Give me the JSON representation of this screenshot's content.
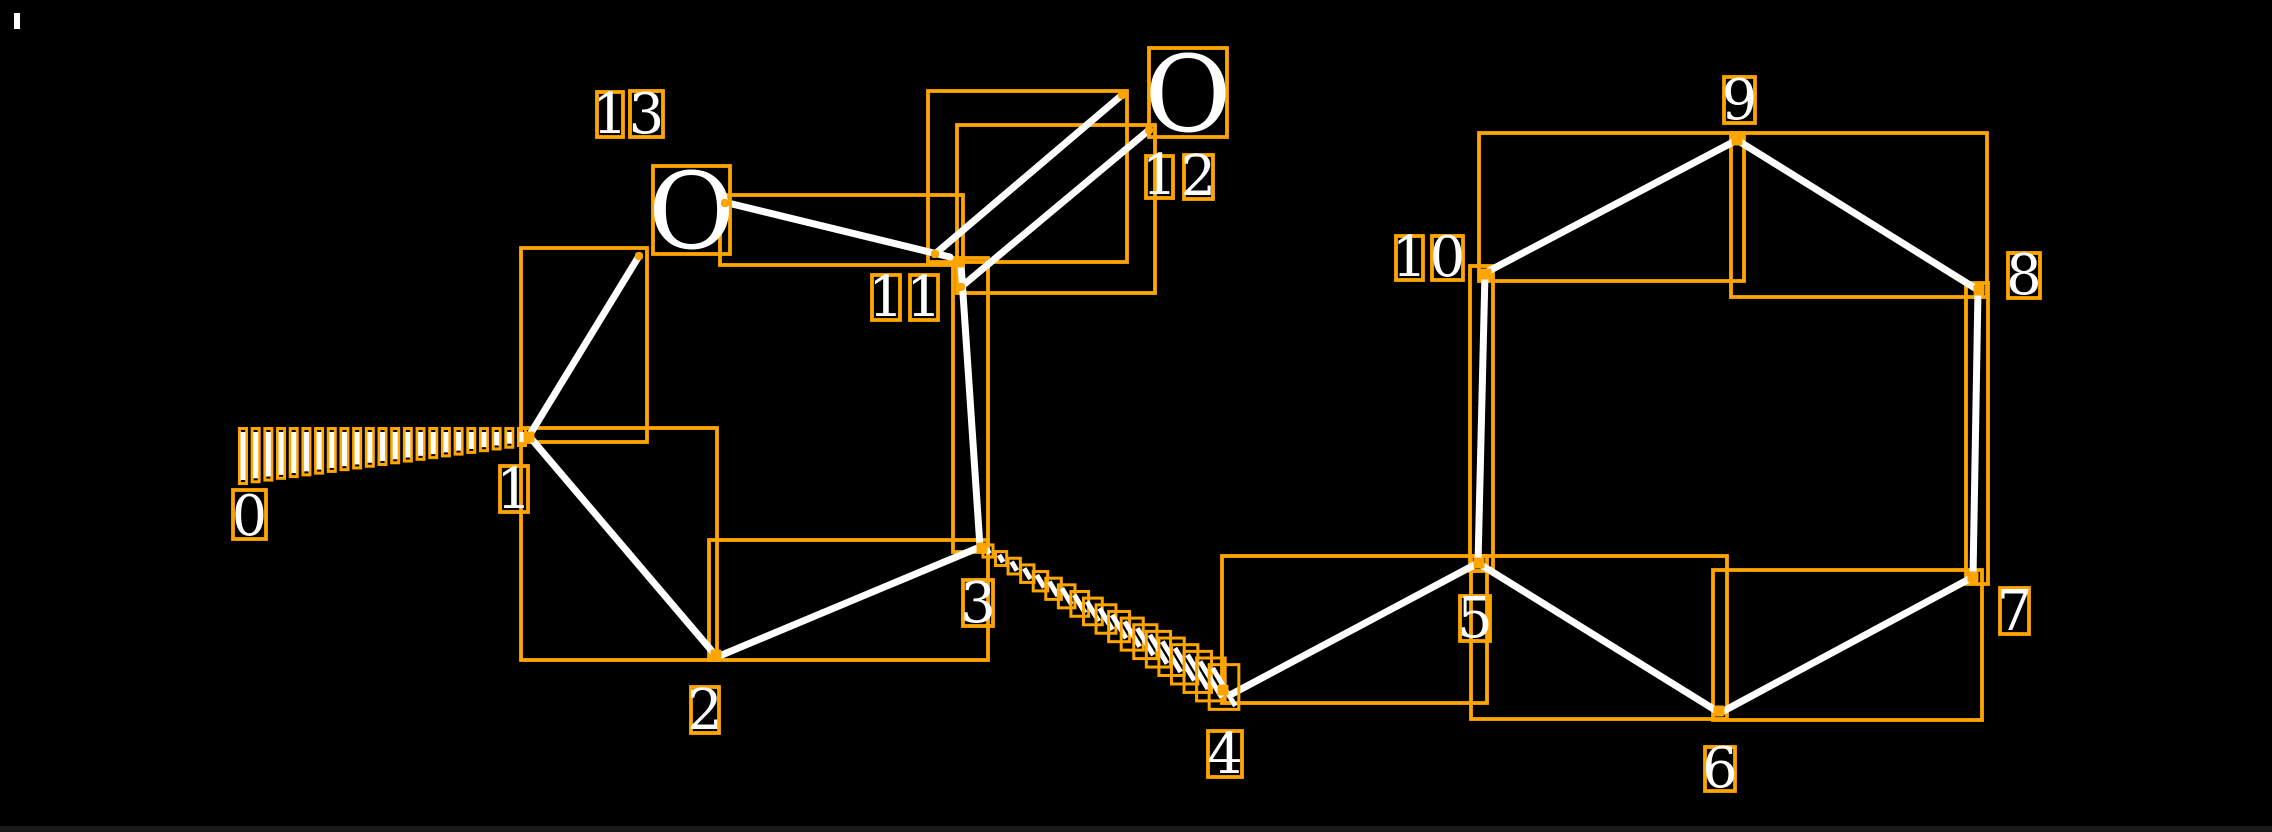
{
  "canvas": {
    "width": 2272,
    "height": 832,
    "background": "#000000",
    "footer_bar": {
      "y": 826,
      "height": 6,
      "color": "#1a1a1a"
    },
    "artifact_speck": {
      "x": 14,
      "y": 13,
      "w": 6,
      "h": 16
    }
  },
  "colors": {
    "box": "#FFA500",
    "bond": "#FFFFFF",
    "label": "#FFFFFF"
  },
  "style": {
    "bond_width": 7,
    "box_stroke": 3.8,
    "dash_width": 5,
    "dash_box_pad": 3.5,
    "digit_font": 56,
    "oxygen_font": 106,
    "marker_size": 11,
    "dot_size": 8
  },
  "molecule": {
    "oxygen_atoms": [
      {
        "name": "oxygen-13",
        "label": "O",
        "box": [
          653,
          166,
          77,
          88
        ]
      },
      {
        "name": "oxygen-12",
        "label": "O",
        "box": [
          1149,
          48,
          78,
          89
        ]
      }
    ],
    "bonds": [
      {
        "name": "bond-1-2",
        "p": [
          529,
          436,
          717,
          657
        ]
      },
      {
        "name": "bond-2-3",
        "p": [
          717,
          657,
          980,
          547
        ]
      },
      {
        "name": "bond-11-3",
        "p": [
          961,
          264,
          980,
          547
        ]
      },
      {
        "name": "bond-1-o13",
        "p": [
          529,
          436,
          639,
          256
        ]
      },
      {
        "name": "bond-o13-11",
        "p": [
          728,
          203,
          950,
          257
        ]
      },
      {
        "name": "bond-11-o12-main",
        "p": [
          935,
          254,
          1122,
          95
        ]
      },
      {
        "name": "bond-11-o12-second",
        "p": [
          961,
          287,
          1149,
          130
        ]
      },
      {
        "name": "bond-4-5",
        "p": [
          1230,
          695,
          1478,
          563
        ]
      },
      {
        "name": "bond-5-6",
        "p": [
          1478,
          563,
          1720,
          713
        ]
      },
      {
        "name": "bond-6-7",
        "p": [
          1720,
          713,
          1973,
          577
        ]
      },
      {
        "name": "bond-7-8",
        "p": [
          1973,
          577,
          1978,
          290
        ]
      },
      {
        "name": "bond-8-9",
        "p": [
          1978,
          290,
          1737,
          140
        ]
      },
      {
        "name": "bond-9-10",
        "p": [
          1737,
          140,
          1485,
          273
        ]
      },
      {
        "name": "bond-10-5",
        "p": [
          1485,
          273,
          1478,
          563
        ]
      }
    ],
    "hash_wedges": [
      {
        "name": "hash-wedge-1-0",
        "x1": 522,
        "y1": 437,
        "x2": 243,
        "y2": 456,
        "count": 23,
        "len1": 10,
        "len2": 48,
        "angle_deg": 90
      },
      {
        "name": "hash-wedge-3-4",
        "x1": 988,
        "y1": 551,
        "x2": 1224,
        "y2": 687,
        "count": 19,
        "len1": 6,
        "len2": 44,
        "angle_deg": 121
      }
    ],
    "bond_boxes": [
      {
        "name": "bbox-bond-1-2",
        "r": [
          521,
          428,
          196,
          232
        ]
      },
      {
        "name": "bbox-bond-2-3",
        "r": [
          709,
          540,
          279,
          120
        ]
      },
      {
        "name": "bbox-bond-11-3",
        "r": [
          953,
          258,
          35,
          294
        ]
      },
      {
        "name": "bbox-bond-1-o13",
        "r": [
          521,
          248,
          126,
          194
        ]
      },
      {
        "name": "bbox-bond-o13-11",
        "r": [
          720,
          195,
          243,
          70
        ]
      },
      {
        "name": "bbox-bond-11-o12-main",
        "r": [
          928,
          91,
          199,
          171
        ]
      },
      {
        "name": "bbox-bond-11-o12-second",
        "r": [
          957,
          125,
          198,
          168
        ]
      },
      {
        "name": "bbox-bond-4-5",
        "r": [
          1222,
          556,
          265,
          147
        ]
      },
      {
        "name": "bbox-bond-5-6",
        "r": [
          1471,
          556,
          256,
          163
        ]
      },
      {
        "name": "bbox-bond-6-7",
        "r": [
          1713,
          570,
          269,
          150
        ]
      },
      {
        "name": "bbox-bond-7-8",
        "r": [
          1966,
          283,
          22,
          301
        ]
      },
      {
        "name": "bbox-bond-8-9",
        "r": [
          1731,
          133,
          256,
          164
        ]
      },
      {
        "name": "bbox-bond-9-10",
        "r": [
          1479,
          133,
          265,
          148
        ]
      },
      {
        "name": "bbox-bond-10-5",
        "r": [
          1470,
          266,
          23,
          305
        ]
      }
    ],
    "index_labels": [
      {
        "name": "atom-label-0",
        "text": "0",
        "box": [
          233,
          490,
          33,
          49
        ]
      },
      {
        "name": "atom-label-1",
        "text": "1",
        "box": [
          500,
          466,
          28,
          46
        ]
      },
      {
        "name": "atom-label-2",
        "text": "2",
        "box": [
          691,
          687,
          28,
          46
        ]
      },
      {
        "name": "atom-label-3",
        "text": "3",
        "box": [
          963,
          580,
          30,
          46
        ]
      },
      {
        "name": "atom-label-4",
        "text": "4",
        "box": [
          1208,
          731,
          34,
          46
        ]
      },
      {
        "name": "atom-label-5",
        "text": "5",
        "box": [
          1460,
          596,
          30,
          45
        ]
      },
      {
        "name": "atom-label-6",
        "text": "6",
        "box": [
          1705,
          747,
          30,
          44
        ]
      },
      {
        "name": "atom-label-7",
        "text": "7",
        "box": [
          2000,
          588,
          29,
          46
        ]
      },
      {
        "name": "atom-label-8",
        "text": "8",
        "box": [
          2008,
          253,
          32,
          45
        ]
      },
      {
        "name": "atom-label-9",
        "text": "9",
        "box": [
          1724,
          77,
          31,
          46
        ]
      },
      {
        "name": "atom-label-10-d1",
        "text": "1",
        "box": [
          1396,
          236,
          27,
          44
        ]
      },
      {
        "name": "atom-label-10-d2",
        "text": "0",
        "box": [
          1432,
          236,
          31,
          44
        ]
      },
      {
        "name": "atom-label-11-d1",
        "text": "1",
        "box": [
          872,
          275,
          28,
          45
        ]
      },
      {
        "name": "atom-label-11-d2",
        "text": "1",
        "box": [
          910,
          275,
          28,
          45
        ]
      },
      {
        "name": "atom-label-12-d1",
        "text": "1",
        "box": [
          1146,
          156,
          27,
          42
        ]
      },
      {
        "name": "atom-label-12-d2",
        "text": "2",
        "box": [
          1184,
          155,
          29,
          44
        ]
      },
      {
        "name": "atom-label-13-d1",
        "text": "1",
        "box": [
          597,
          92,
          26,
          45
        ]
      },
      {
        "name": "atom-label-13-d2",
        "text": "3",
        "box": [
          630,
          91,
          33,
          46
        ]
      }
    ],
    "junction_markers": [
      {
        "name": "junction-marker-1",
        "c": [
          529,
          437
        ]
      },
      {
        "name": "junction-marker-2",
        "c": [
          716,
          655
        ]
      },
      {
        "name": "junction-marker-3",
        "c": [
          982,
          548
        ]
      },
      {
        "name": "junction-marker-4",
        "c": [
          1223,
          690
        ]
      },
      {
        "name": "junction-marker-5",
        "c": [
          1479,
          563
        ]
      },
      {
        "name": "junction-marker-6",
        "c": [
          1719,
          711
        ]
      },
      {
        "name": "junction-marker-7",
        "c": [
          1973,
          577
        ]
      },
      {
        "name": "junction-marker-8",
        "c": [
          1979,
          290
        ]
      },
      {
        "name": "junction-marker-9",
        "c": [
          1737,
          140
        ]
      },
      {
        "name": "junction-marker-10",
        "c": [
          1486,
          274
        ]
      },
      {
        "name": "junction-marker-11",
        "c": [
          959,
          262
        ]
      }
    ],
    "endpoint_dots": [
      {
        "name": "endpoint-dot-o13-left",
        "c": [
          639,
          256
        ]
      },
      {
        "name": "endpoint-dot-o13-right",
        "c": [
          725,
          203
        ]
      },
      {
        "name": "endpoint-dot-11-a",
        "c": [
          935,
          254
        ]
      },
      {
        "name": "endpoint-dot-11-b",
        "c": [
          961,
          287
        ]
      },
      {
        "name": "endpoint-dot-o12-a",
        "c": [
          1122,
          95
        ]
      },
      {
        "name": "endpoint-dot-o12-b",
        "c": [
          1149,
          130
        ]
      }
    ]
  }
}
